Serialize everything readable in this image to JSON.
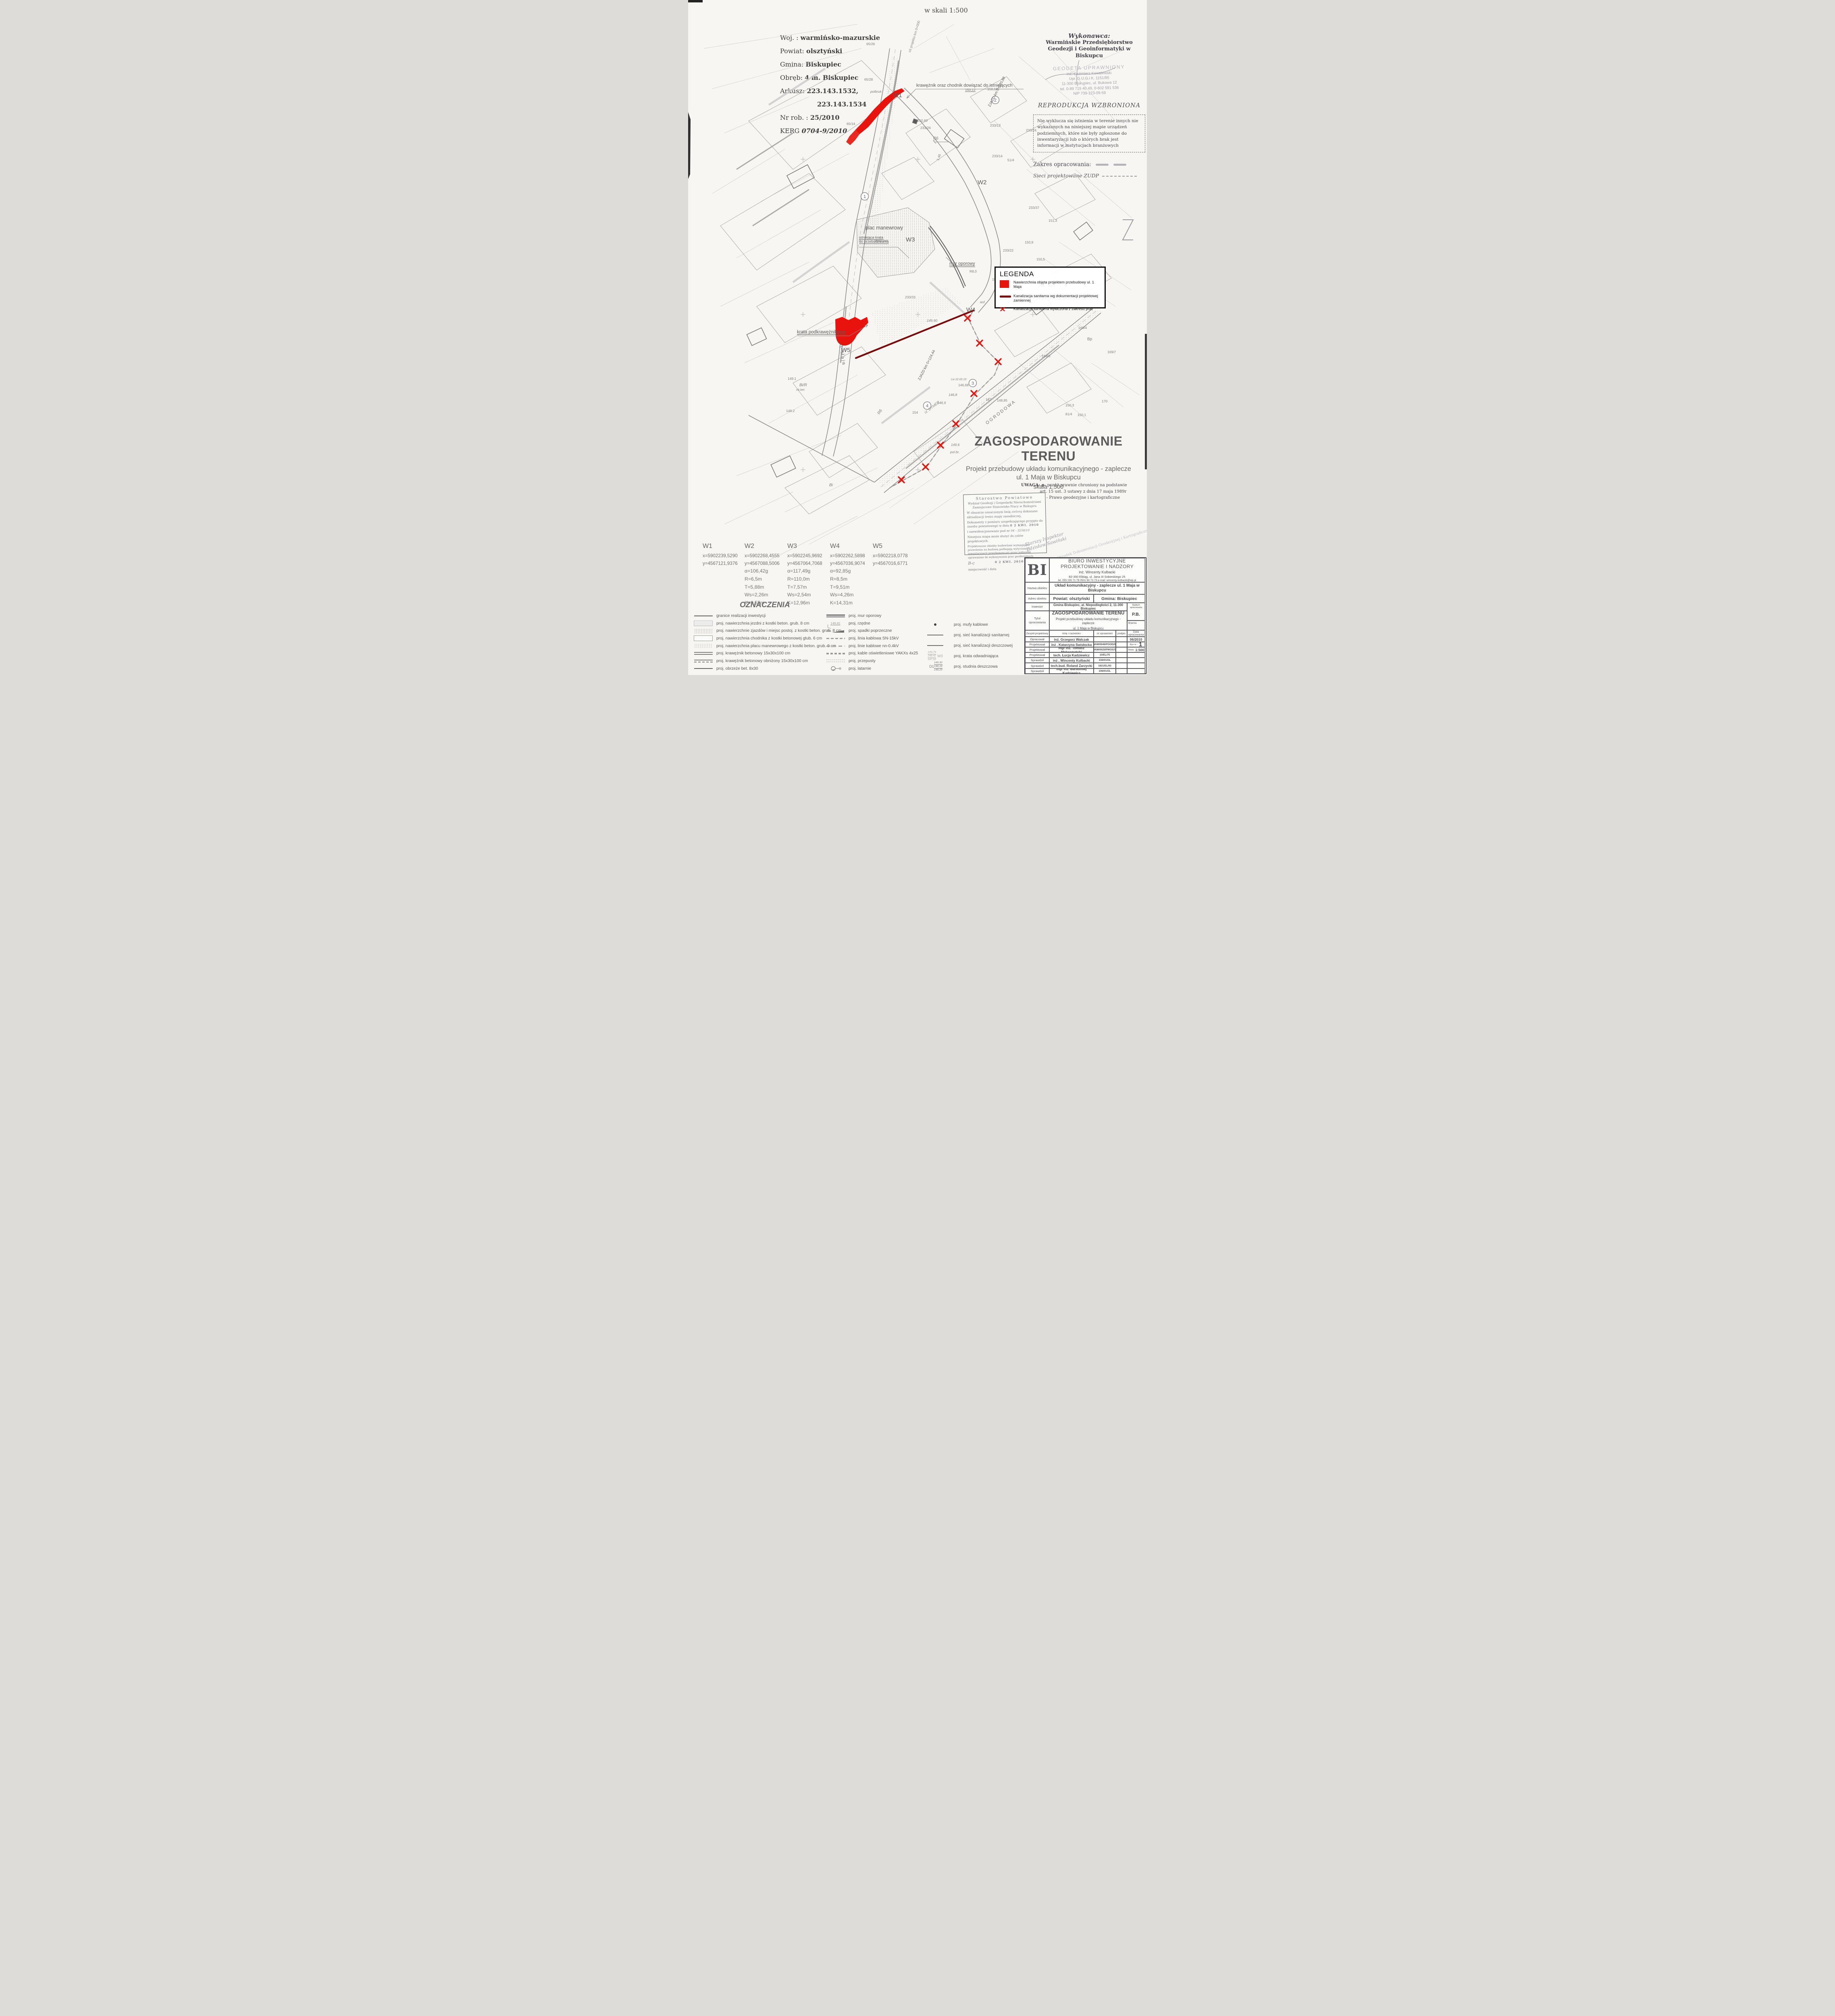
{
  "scale_note": "w skali 1:500",
  "sheet_info": {
    "lines": [
      {
        "label": "Woj. :",
        "value": "warmińsko-mazurskie"
      },
      {
        "label": "Powiat:",
        "value": "olsztyński"
      },
      {
        "label": "Gmina:",
        "value": "Biskupiec"
      },
      {
        "label": "Obręb:",
        "value": "4 m. Biskupiec"
      },
      {
        "label": "Arkusz:",
        "value": "223.143.1532,"
      },
      {
        "label": "",
        "value": "223.143.1534"
      },
      {
        "label": "Nr rob. :",
        "value": "25/2010"
      },
      {
        "label": "KERG",
        "value": "0704-9/2010"
      }
    ]
  },
  "contractor": {
    "heading": "Wykonawca:",
    "name_line1": "Warmińskie Przedsiębiorstwo",
    "name_line2": "Geodezji i Geoinformatyki w Biskupcu",
    "stamp_line1": "GEODETA UPRAWNIONY",
    "stamp_line2": "inż. Kazimierz Kowalewski",
    "stamp_line3": "Upr. G.U.G.i K. 1151/85",
    "stamp_line4": "11-300 Biskupiec, ul. Bukowa 12",
    "stamp_line5": "tel. 0-89 715 40 49, 0-602 591 536",
    "stamp_line6": "NIP 739-123-09-59",
    "reproduction": "REPRODUKCJA WZBRONIONA",
    "disclaimer": "Nie wyklucza się istnienia w terenie innych nie wykazanych na niniejszej mapie urządzeń podziemnych, które nie były zgłoszone do inwentaryzacji lub o których brak jest informacji w instytucjach branżowych",
    "zakres_label": "Zakres opracowania:",
    "zudp_line": "Sieci projektowane  ZUDP"
  },
  "legend": {
    "title": "LEGENDA",
    "colors": {
      "red": "#e8130c",
      "dark_red": "#7a0a0a"
    },
    "items": [
      {
        "symbol": "red-area",
        "label": "Nawierzchnia objęta projektem przebudowy ul. 1 Maja"
      },
      {
        "symbol": "dark-red-line",
        "label": "Kanalizacja sanitarna wg dokumentacji projektowej zamiennej"
      },
      {
        "symbol": "red-x",
        "label": "Kanalizacja sanitarna wyłaczona z zakresu prac",
        "x_glyph": "✕"
      }
    ]
  },
  "map_labels": {
    "w1": "W1",
    "w2": "W2",
    "w3": "W3",
    "w4": "W4",
    "w5": "W5",
    "plac_manewrowy": "plac manewrowy",
    "plyty_bet": "płyty bet.",
    "mur_oporowy": "mur oporowy",
    "krata_podkraweznikowa": "krata podkrawężnikowa",
    "istniejaca_krata_1": "istniejąca krata",
    "istniejaca_krata_2": "do przebudowania",
    "kraweznik_note": "krawężnik oraz chodnik dowiązać do istniejących",
    "zjazd1": "ZJAZD km 0+020,88",
    "zjazd2": "ZJAZD km 0+124,44",
    "os_projektu": "oś projektu km 0+000",
    "ulica_maja": "1 Maja",
    "ogrodowa": "OGRODOWA",
    "rz_dymer": "rz. DYMER",
    "circled": [
      "1",
      "2",
      "3",
      "4"
    ]
  },
  "scatter": [
    {
      "t": "65/26"
    },
    {
      "t": "65/28"
    },
    {
      "t": "polbruk"
    },
    {
      "t": "65/14"
    },
    {
      "t": "233/13"
    },
    {
      "t": "233/24"
    },
    {
      "t": "233/14"
    },
    {
      "t": "51/4"
    },
    {
      "t": "233/37"
    },
    {
      "t": "151,3"
    },
    {
      "t": "233/22"
    },
    {
      "t": "150,5"
    },
    {
      "t": "150,9"
    },
    {
      "t": "168/4"
    },
    {
      "t": "Bp"
    },
    {
      "t": "168/6"
    },
    {
      "t": "169/7"
    },
    {
      "t": "167"
    },
    {
      "t": "148,85"
    },
    {
      "t": "170"
    },
    {
      "t": "150,3"
    },
    {
      "t": "81/4"
    },
    {
      "t": "150,1"
    },
    {
      "t": "233/26"
    },
    {
      "t": "150,60"
    },
    {
      "t": "150,12"
    },
    {
      "t": "150,16"
    },
    {
      "t": "149,90"
    },
    {
      "t": "146,68"
    },
    {
      "t": "Lw 22.03.10"
    },
    {
      "t": "146,9"
    },
    {
      "t": "146,8"
    },
    {
      "t": "149,6"
    },
    {
      "t": "154"
    },
    {
      "t": "Bi/R"
    },
    {
      "t": "149.1"
    },
    {
      "t": "149.2"
    },
    {
      "t": "Bi"
    },
    {
      "t": "ch.bet"
    },
    {
      "t": "asf."
    },
    {
      "t": "R8,0"
    },
    {
      "t": "157,0"
    },
    {
      "t": "R6"
    },
    {
      "t": "R6"
    },
    {
      "t": "1,46"
    },
    {
      "t": "233/33"
    },
    {
      "t": "pol.br."
    }
  ],
  "title_area": {
    "main": "ZAGOSPODAROWANIE TERENU",
    "sub1": "Projekt przebudowy układu komunikacyjnego - zaplecze",
    "sub2": "ul. 1 Maja w Biskupcu",
    "scale": "skala 1:500"
  },
  "uwaga": {
    "label": "UWAGA:",
    "dot": "●",
    "line1": "- punkt prawnie chroniony na podstawie",
    "line2": "art. 15 ust. 3 ustawy z dnia 17 maja 1989r",
    "line3": "- Prawo geodezyjne i kartograficzne"
  },
  "stamp": {
    "line1": "Starostwo Powiatowe",
    "line2": "Wydział Geodezji i Gospodarki Nieruchomościami",
    "line3": "Zamiejscowe Stanowisko Pracy w Biskupcu",
    "body1": "W obszarze oznaczonym linią",
    "hand1": "zieloną",
    "body1b": "dokonano",
    "body2": "aktualizacji treści mapy zasadniczej.",
    "body3": "Dokumenty z pomiaru uzupełniającego przyjęto do",
    "body4": "zasobu powiatowego w dniu",
    "date_stamp": "0 2 KWI. 2010",
    "body5": "i zaewidencjonowano pod nr",
    "hand2": "04 - 3258/10",
    "body6": "Niniejsza mapa może służyć do celów projektowych.",
    "body7": "Projektowane obiekty budowlane wymagające pozwolenia na budowę podlegają wytyczeniu i inwentaryzacji powykonawczej przez jednostki uprawnione do wykonywania prac geodezyjnych.",
    "hand3": "B-c",
    "date_stamp2": "0 2 KWI. 2010",
    "foot_left": "miejscowość i data",
    "foot_right": "podpis",
    "inspector": "Starszy Inspektor",
    "inspector_name": "Zdzisław Sawiński",
    "podgik": "Powiatowy Ośrodek Dokumentacji Geodezyjnej i Kartograficznej"
  },
  "vertices": [
    {
      "id": "W1",
      "x": "x=5902239,5290",
      "y": "y=4567121,9376",
      "params": []
    },
    {
      "id": "W2",
      "x": "x=5902268,4555",
      "y": "y=4567088,5006",
      "params": [
        "α=106,42g",
        "R=6,5m",
        "T=5,88m",
        "Ws=2,26m",
        "K=9,55m"
      ]
    },
    {
      "id": "W3",
      "x": "x=5902245,9692",
      "y": "y=4567064,7068",
      "params": [
        "α=117,49g",
        "R=110,0m",
        "T=7,57m",
        "Ws=2,54m",
        "K=12,96m"
      ]
    },
    {
      "id": "W4",
      "x": "x=5902262,5898",
      "y": "y=4567036,9074",
      "params": [
        "α=92,85g",
        "R=8,5m",
        "T=9,51m",
        "Ws=4,26m",
        "K=14,31m"
      ]
    },
    {
      "id": "W5",
      "x": "x=5902218,0778",
      "y": "y=4567016,6771",
      "params": []
    }
  ],
  "oznaczenia": {
    "title": "OZNACZENIA",
    "col1": [
      {
        "label": "granice realizacji inwestycji"
      },
      {
        "label": "proj. nawierzchnia jezdni z kostki beton. grub. 8 cm"
      },
      {
        "label": "proj. nawierzchnie zjazdów i miejsc postoj. z kostki beton. grub. 8 cm"
      },
      {
        "label": "proj. nawierzchnia chodnika z kostki betonowej gtub. 6 cm"
      },
      {
        "label": "proj. nawierzchnia placu manewrowego z kostki beton. grub. 8 cm"
      },
      {
        "label": "proj. krawężnik betonowy 15x30x100 cm"
      },
      {
        "label": "proj. krawężnik betonowy obniżony 15x30x100 cm"
      },
      {
        "label": "proj. obrzeże bet. 8x30"
      }
    ],
    "col2": [
      {
        "label": "proj. mur oporowy"
      },
      {
        "label": "proj. rzędne",
        "note": "149,81"
      },
      {
        "label": "proj. spadki poprzeczne",
        "note": "2%"
      },
      {
        "label": "proj. linia kablowa SN-15kV"
      },
      {
        "label": "proj. linie kablowe nn-0.4kV"
      },
      {
        "label": "proj. kable oświetleniowe YAKXs 4x25"
      },
      {
        "label": "proj. przepusty"
      },
      {
        "label": "proj. latarnie"
      }
    ],
    "col3": [
      {
        "label": "proj. mufy kablowe"
      },
      {
        "label": "proj. sieć kanalizacji sanitarnej"
      },
      {
        "label": "proj. sieć kanalizacji deszczowej"
      },
      {
        "label": "proj. krata odwadniająca"
      },
      {
        "label": "proj. studnia deszczowa"
      }
    ],
    "sym_w3": {
      "l1": "149,76",
      "l2": "148,42",
      "l3": "147,52",
      "name": "W3"
    },
    "sym_d1": {
      "l1": "149,30",
      "l2": "148,16",
      "l3": "148,25",
      "name": "D1"
    }
  },
  "titleblock": {
    "logo": "BI",
    "company_line1": "BIURO INWESTYCYJNE",
    "company_line2": "PROJEKTOWANIE I NADZORY",
    "company_line3": "inż. Wincenty Kulbacki",
    "company_line4": "82-300 Elbląg, ul. Jana III Sobieskiego 25",
    "company_line5": "tel. 055 235 71 78   0501 64 73 73     e-mail: wincenty-kulbacki@wp.pl",
    "nazwa_label": "Nazwa obiektu",
    "nazwa_value": "Układ komunikacyjny - zaplecze ul. 1 Maja w Biskupcu",
    "adres_label": "Adres obiektu",
    "adres_value1": "Powiat: olsztyński",
    "adres_value2": "Gmina: Biskupiec",
    "inwestor_label": "Inwestor",
    "inwestor_value": "Gmina Biskupiec, al. Niepodległości 2, 11-300 Biskupiec",
    "stadium_label": "Stadium opracowania",
    "stadium_value": "P.B.",
    "tytul_label1": "Tytuł",
    "tytul_label2": "opracowania",
    "tytul_value1": "ZAGOSPODAROWANIE TERENU",
    "tytul_value2": "Projekt przebudowy układu komunikacyjnego - zaplecze",
    "tytul_value3": "ul. 1 Maja w Biskupcu",
    "branza_label": "Branża",
    "team_header": {
      "col1": "Zespół projektowy",
      "col2": "imię i nazwisko",
      "col3": "nr uprawnień",
      "col4": "podpis",
      "col5": "Data opracowania"
    },
    "rys_label": "Rys nr :",
    "rys_value": "1",
    "skala_label": "Skala:",
    "skala_value": "1:500",
    "personnel": [
      {
        "role": "Opracował",
        "name": "inż.  Grzegorz Walczak",
        "cert": "",
        "extra": "06/2010"
      },
      {
        "role": "Projektował",
        "name": "inż .  Katarzyna Swisłocka",
        "cert": "WAM/0046/POOD/09"
      },
      {
        "role": "Projektował",
        "name": "mgr inż. Tomasz Mrówczyński",
        "cert": "WAM/0025/PWOS/10"
      },
      {
        "role": "Projektował",
        "name": "tech. Łucja Kadziewicz",
        "cert": "10/EL/75"
      },
      {
        "role": "Sprawdził",
        "name": "inż .  Wincenty Kulbacki",
        "cert": "156/01/OL"
      },
      {
        "role": "Sprawdził",
        "name": "tech.bud. Roland Zarzycki",
        "cert": "1821/EL/93"
      },
      {
        "role": "Sprawdził",
        "name": "mgr inż. Bartłomiej Kadziewicz",
        "cert": "106/01/OL"
      }
    ]
  }
}
